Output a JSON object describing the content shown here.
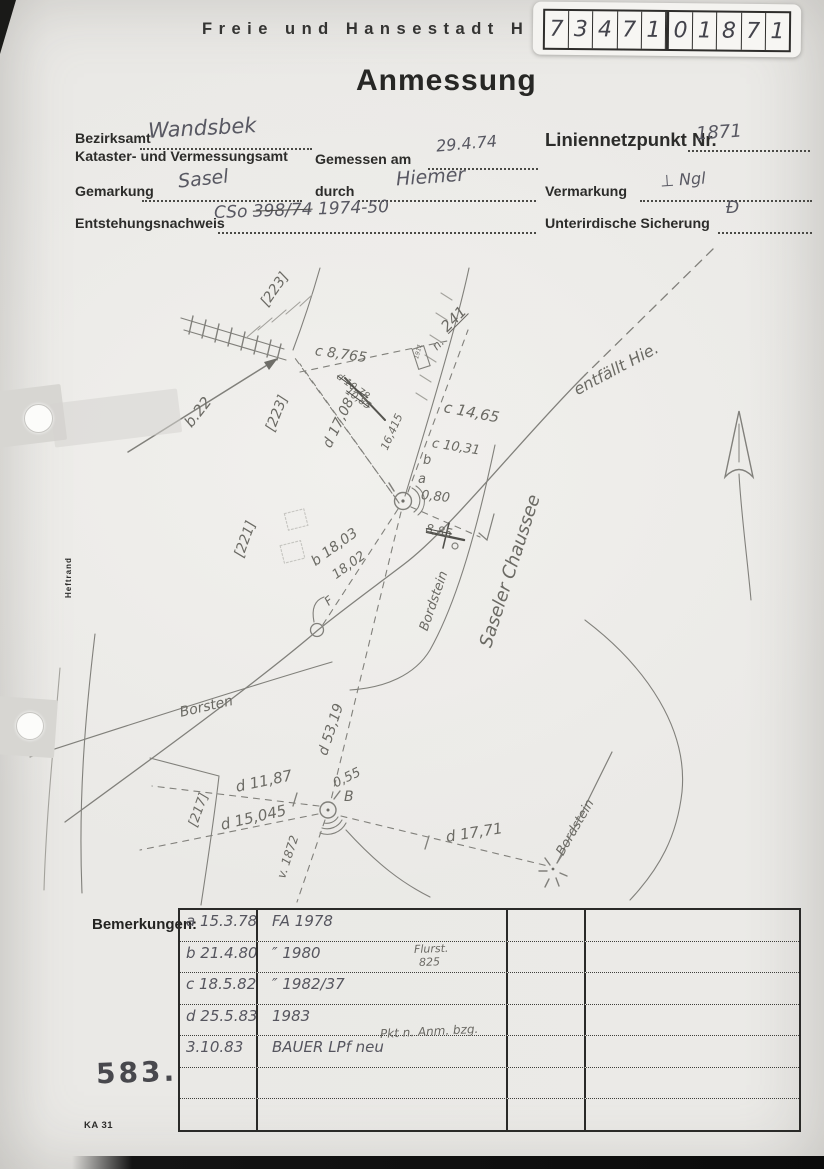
{
  "colors": {
    "paper": "#eae9e6",
    "pencil": "#7b7a76",
    "print_ink": "#2b2b29"
  },
  "header": {
    "city_line": "Freie und Hansestadt H",
    "title": "Anmessung",
    "point_id_digits": [
      "7",
      "3",
      "4",
      "7",
      "1",
      "0",
      "1",
      "8",
      "7",
      "1"
    ]
  },
  "form": {
    "bezirksamt_label": "Bezirksamt",
    "bezirksamt_value": "Wandsbek",
    "amt_label": "Kataster- und Vermessungsamt",
    "gemessen_label": "Gemessen am",
    "gemessen_value": "29.4.74",
    "gemarkung_label": "Gemarkung",
    "gemarkung_value": "Sasel",
    "durch_label": "durch",
    "durch_value": "Hiemer",
    "entstehung_label": "Entstehungsnachweis",
    "entstehung_prefix": "CSo",
    "entstehung_struck": "398/74",
    "entstehung_suffix": "1974-50",
    "liniennetzpunkt_label": "Liniennetzpunkt Nr.",
    "liniennetzpunkt_value": "1871",
    "vermarkung_label": "Vermarkung",
    "vermarkung_value": "⊥ Ngl",
    "sicherung_label": "Unterirdische Sicherung",
    "sicherung_value": "Đ"
  },
  "margin": {
    "heftrand": "Heftrand"
  },
  "sketch": {
    "labels": [
      {
        "id": "bracket-223-a",
        "text": "[223]",
        "x": 264,
        "y": 298,
        "rot": -55,
        "size": 14
      },
      {
        "id": "bracket-223-b",
        "text": "[223]",
        "x": 270,
        "y": 424,
        "rot": -68,
        "size": 14
      },
      {
        "id": "bracket-221",
        "text": "[221]",
        "x": 239,
        "y": 550,
        "rot": -70,
        "size": 14
      },
      {
        "id": "bracket-217",
        "text": "[217]",
        "x": 193,
        "y": 820,
        "rot": -70,
        "size": 13
      },
      {
        "id": "b-22",
        "text": "b.22",
        "x": 188,
        "y": 418,
        "rot": -52,
        "size": 15
      },
      {
        "id": "c-8765",
        "text": "c 8,765",
        "x": 315,
        "y": 344,
        "rot": 8,
        "size": 14
      },
      {
        "id": "struck-d-1078",
        "text": "d 10,78",
        "x": 337,
        "y": 371,
        "rot": 36,
        "size": 10,
        "struck": true
      },
      {
        "id": "struck-1085",
        "text": "10,85",
        "x": 346,
        "y": 386,
        "rot": 36,
        "size": 10,
        "struck": true
      },
      {
        "id": "d-1708",
        "text": "d 17,08",
        "x": 327,
        "y": 440,
        "rot": -64,
        "size": 14
      },
      {
        "id": "m-16415",
        "text": "16,415",
        "x": 384,
        "y": 444,
        "rot": -66,
        "size": 11
      },
      {
        "id": "n-dot",
        "text": "n.",
        "x": 434,
        "y": 342,
        "rot": -45,
        "size": 12
      },
      {
        "id": "n-241",
        "text": "241",
        "x": 444,
        "y": 322,
        "rot": -45,
        "size": 15,
        "underline": true
      },
      {
        "id": "plaque-1911",
        "text": "1911",
        "x": 417,
        "y": 356,
        "rot": -75,
        "size": 6
      },
      {
        "id": "c-1465",
        "text": "c 14,65",
        "x": 444,
        "y": 400,
        "rot": 11,
        "size": 15
      },
      {
        "id": "c-1031",
        "text": "c 10,31",
        "x": 432,
        "y": 437,
        "rot": 9,
        "size": 13
      },
      {
        "id": "pt-b",
        "text": "b",
        "x": 423,
        "y": 454,
        "rot": 0,
        "size": 13
      },
      {
        "id": "pt-a",
        "text": "a",
        "x": 418,
        "y": 473,
        "rot": 0,
        "size": 13
      },
      {
        "id": "v-080",
        "text": "0,80",
        "x": 421,
        "y": 489,
        "rot": 6,
        "size": 13
      },
      {
        "id": "struck-885",
        "text": "8,85",
        "x": 426,
        "y": 522,
        "rot": 12,
        "size": 12,
        "struck": true
      },
      {
        "id": "entfaellt",
        "text": "entfällt Hie.",
        "x": 575,
        "y": 383,
        "rot": -28,
        "size": 16
      },
      {
        "id": "saseler-chaussee",
        "text": "Saseler Chaussee",
        "x": 486,
        "y": 638,
        "rot": -72,
        "size": 18
      },
      {
        "id": "bordstein-upper",
        "text": "Bordstein",
        "x": 424,
        "y": 624,
        "rot": -71,
        "size": 13
      },
      {
        "id": "b-1803",
        "text": "b 18,03",
        "x": 313,
        "y": 556,
        "rot": -36,
        "size": 14
      },
      {
        "id": "b-1802",
        "text": "18,02",
        "x": 334,
        "y": 570,
        "rot": -36,
        "size": 13
      },
      {
        "id": "pt-F",
        "text": "F",
        "x": 326,
        "y": 597,
        "rot": -40,
        "size": 12
      },
      {
        "id": "borsten",
        "text": "Borsten",
        "x": 180,
        "y": 706,
        "rot": -13,
        "size": 14
      },
      {
        "id": "d-5319",
        "text": "d 53,19",
        "x": 323,
        "y": 748,
        "rot": -72,
        "size": 14
      },
      {
        "id": "d-1187",
        "text": "d 11,87",
        "x": 236,
        "y": 780,
        "rot": -12,
        "size": 15
      },
      {
        "id": "d-15045",
        "text": "d 15,045",
        "x": 221,
        "y": 818,
        "rot": -13,
        "size": 15
      },
      {
        "id": "v-055",
        "text": "0,55",
        "x": 334,
        "y": 778,
        "rot": -26,
        "size": 13
      },
      {
        "id": "pt-B",
        "text": "B",
        "x": 344,
        "y": 790,
        "rot": 0,
        "size": 14
      },
      {
        "id": "d-1771",
        "text": "d 17,71",
        "x": 446,
        "y": 830,
        "rot": -9,
        "size": 15
      },
      {
        "id": "v-1872",
        "text": "v. 1872",
        "x": 281,
        "y": 872,
        "rot": -72,
        "size": 12
      },
      {
        "id": "bordstein-lower",
        "text": "Bordstein",
        "x": 560,
        "y": 848,
        "rot": -60,
        "size": 13
      }
    ]
  },
  "remarks": {
    "label": "Bemerkungen:",
    "rows": [
      [
        "a 15.3.78",
        "FA 1978",
        "",
        ""
      ],
      [
        "b 21.4.80",
        "″ 1980",
        "",
        ""
      ],
      [
        "c 18.5.82",
        "″ 1982/37",
        "",
        ""
      ],
      [
        "d 25.5.83",
        "1983",
        "",
        ""
      ],
      [
        "3.10.83",
        "BAUER LPf neu",
        "",
        ""
      ],
      [
        "",
        "",
        "",
        ""
      ],
      [
        "",
        "",
        "",
        ""
      ]
    ],
    "overlays": [
      {
        "id": "flurstueck",
        "text": "Flurst.",
        "x": 414,
        "y": 944,
        "rot": -2,
        "size": 11
      },
      {
        "id": "flurstueck-nr",
        "text": "825",
        "x": 419,
        "y": 957,
        "rot": -2,
        "size": 11
      },
      {
        "id": "pkt-note",
        "text": "Pkt n. Anm. bzg.",
        "x": 380,
        "y": 1028,
        "rot": -3,
        "size": 12
      }
    ]
  },
  "footer": {
    "number": "583.",
    "form_code": "KA 31"
  }
}
